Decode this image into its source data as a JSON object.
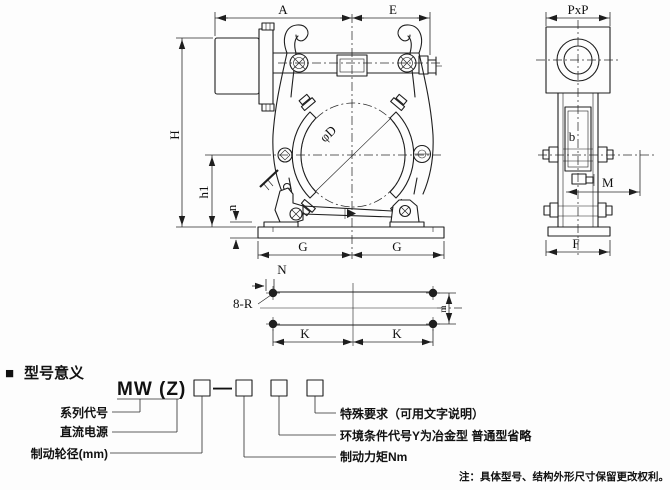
{
  "front_view": {
    "dim_a": "A",
    "dim_e": "E",
    "dim_h": "H",
    "dim_h1": "h1",
    "dim_n": "n",
    "dim_g_left": "G",
    "dim_g_right": "G",
    "drum_diameter": "φD"
  },
  "side_view": {
    "dim_pxp": "PxP",
    "dim_b": "b",
    "dim_m": "M",
    "dim_f": "F"
  },
  "plan_view": {
    "dim_n": "N",
    "holes_label": "8-R",
    "dim_k_left": "K",
    "dim_k_right": "K",
    "dim_m": "m"
  },
  "model_section": {
    "marker": "■",
    "title": "型号意义",
    "model_prefix": "MW (Z)",
    "dash": "—",
    "left_labels": [
      "系列代号",
      "直流电源",
      "制动轮径(mm)"
    ],
    "right_labels": [
      "特殊要求（可用文字说明）",
      "环境条件代号Y为冶金型 普通型省略",
      "制动力矩Nm"
    ],
    "note": "注：具体型号、结构外形尺寸保留更改权利。"
  }
}
